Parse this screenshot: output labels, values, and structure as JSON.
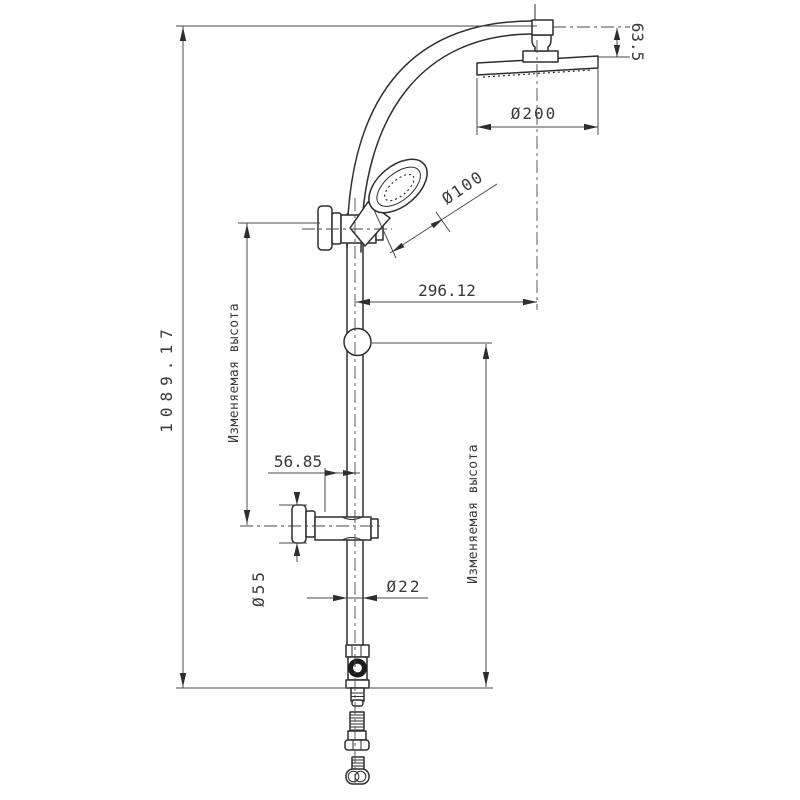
{
  "drawing": {
    "labels": {
      "overall_height": "1089.17",
      "adjustable_height_left": "Изменяемая высота",
      "adjustable_height_right": "Изменяемая высота",
      "horizontal_offset": "296.12",
      "hand_shower_diameter": "Ø100",
      "head_diameter": "Ø200",
      "head_drop": "63.5",
      "bracket_offset": "56.85",
      "flange_diameter": "Ø55",
      "tube_diameter": "Ø22"
    },
    "colors": {
      "line": "#2e2e2e",
      "dimension": "#4a4a4a",
      "background": "#ffffff",
      "knob": "#1c1c1c"
    }
  }
}
